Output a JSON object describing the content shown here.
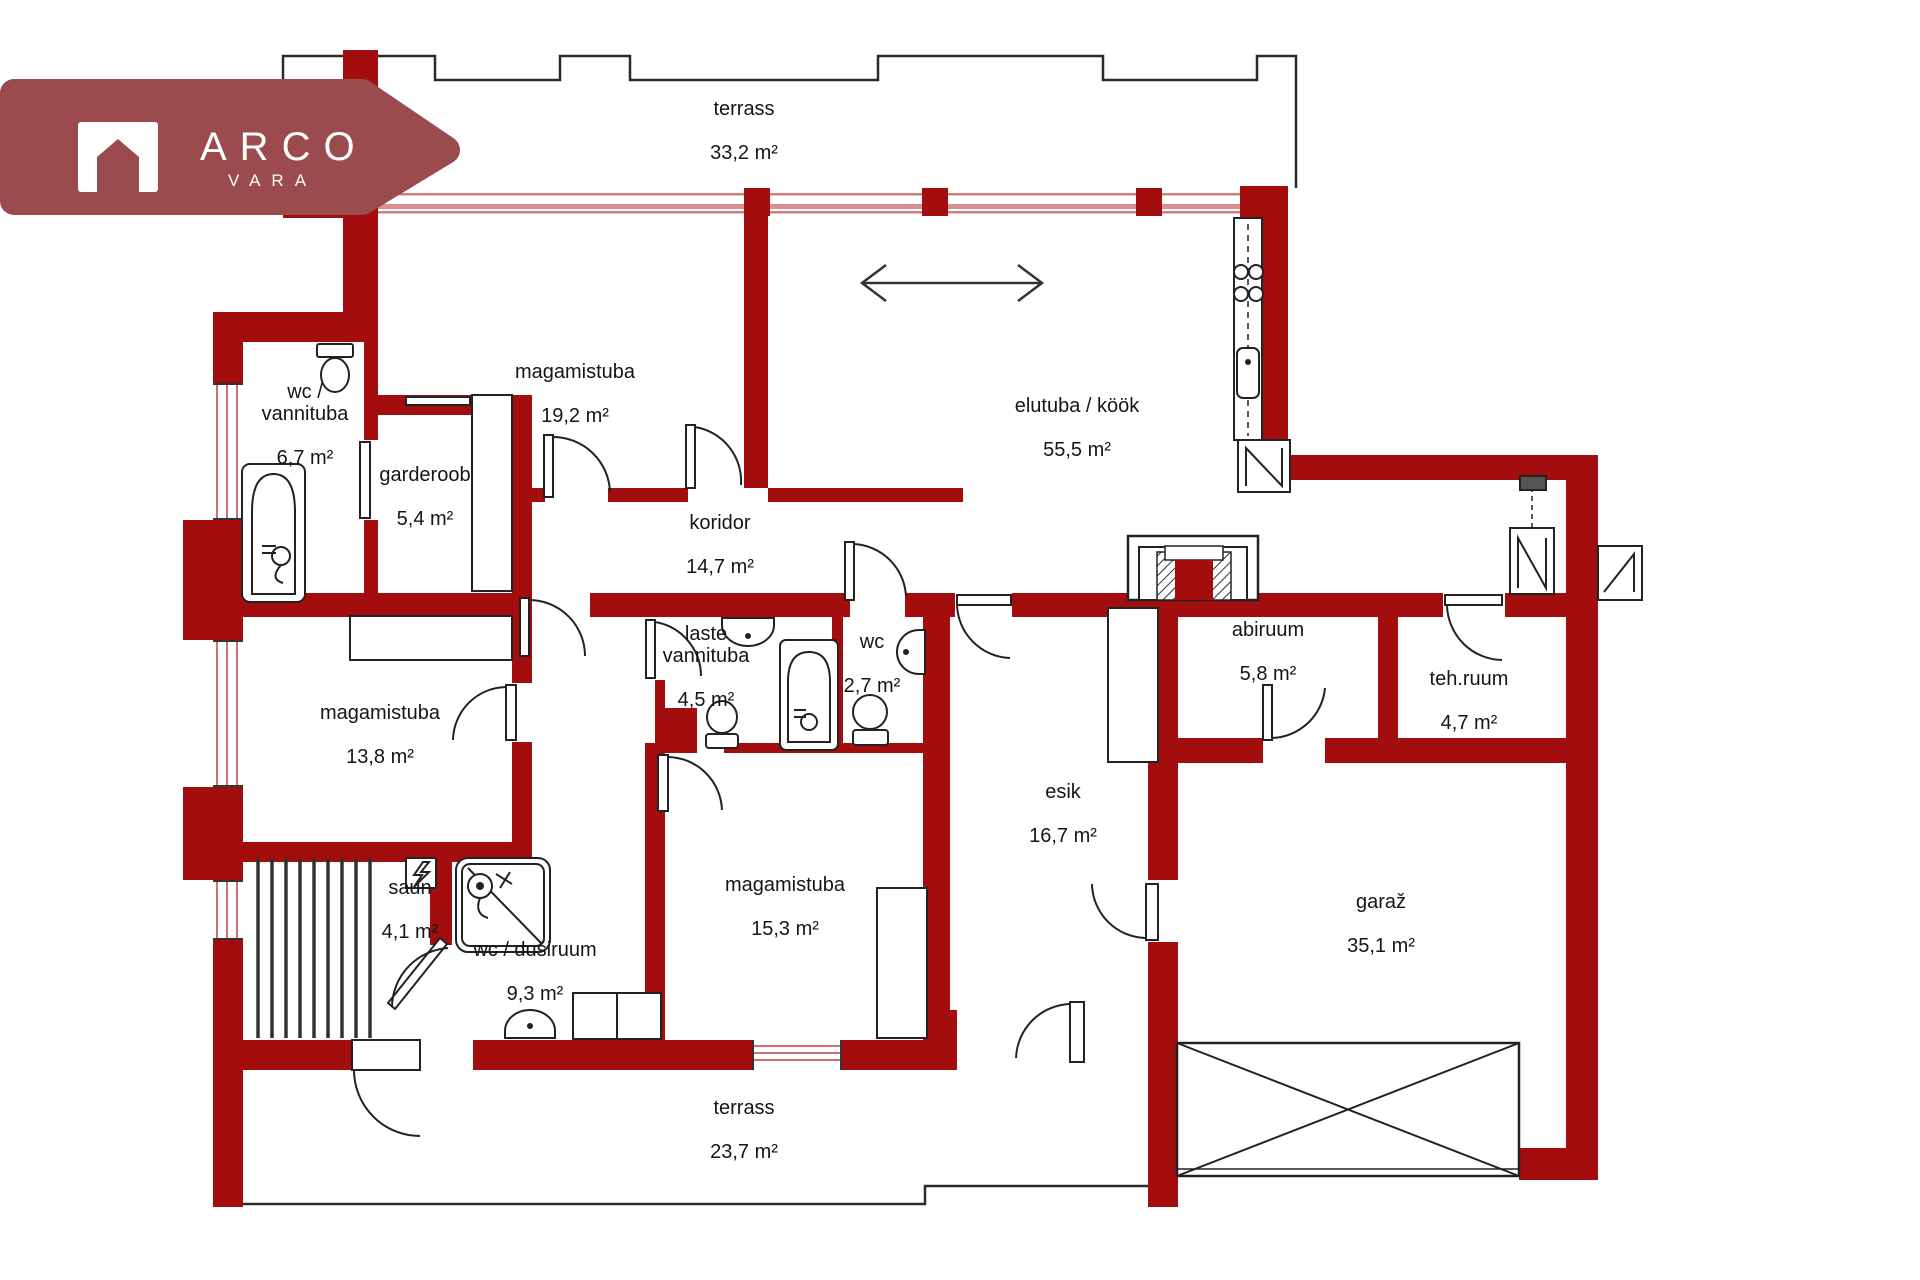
{
  "brand": {
    "title": "ARCO",
    "subtitle": "VARA"
  },
  "colors": {
    "wall": "#A30D0D",
    "banner": "#9B4A4D",
    "window_line": "#CE8080",
    "fixture_line": "#222222"
  },
  "unit": "m²",
  "rooms": [
    {
      "id": "terrass-top",
      "name": "terrass",
      "area": "33,2 m²"
    },
    {
      "id": "magamistuba-19",
      "name": "magamistuba",
      "area": "19,2 m²"
    },
    {
      "id": "elutuba-kook",
      "name": "elutuba / köök",
      "area": "55,5 m²"
    },
    {
      "id": "wc-vannituba",
      "name": "wc /\nvannituba",
      "area": "6,7 m²"
    },
    {
      "id": "garderoob",
      "name": "garderoob",
      "area": "5,4 m²"
    },
    {
      "id": "koridor",
      "name": "koridor",
      "area": "14,7 m²"
    },
    {
      "id": "laste-vannituba",
      "name": "laste\nvannituba",
      "area": "4,5 m²"
    },
    {
      "id": "wc",
      "name": "wc",
      "area": "2,7 m²"
    },
    {
      "id": "abiruum",
      "name": "abiruum",
      "area": "5,8 m²"
    },
    {
      "id": "teh-ruum",
      "name": "teh.ruum",
      "area": "4,7 m²"
    },
    {
      "id": "magamistuba-13",
      "name": "magamistuba",
      "area": "13,8 m²"
    },
    {
      "id": "esik",
      "name": "esik",
      "area": "16,7 m²"
    },
    {
      "id": "saun",
      "name": "saun",
      "area": "4,1 m²"
    },
    {
      "id": "wc-dusiruum",
      "name": "wc / duširuum",
      "area": "9,3 m²"
    },
    {
      "id": "magamistuba-15",
      "name": "magamistuba",
      "area": "15,3 m²"
    },
    {
      "id": "garaz",
      "name": "garaž",
      "area": "35,1 m²"
    },
    {
      "id": "terrass-bottom",
      "name": "terrass",
      "area": "23,7 m²"
    }
  ]
}
